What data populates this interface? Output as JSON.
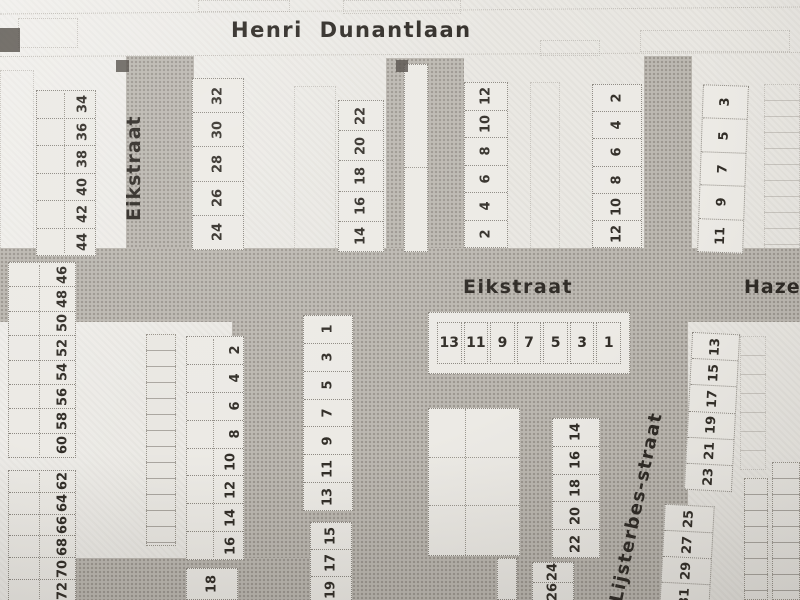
{
  "streets": {
    "henri_dunantlaan": "Henri Dunantlaan",
    "eikstraat_north": "Eikstraat",
    "eikstraat_mid": "Eikstraat",
    "hazelaarstraat_partial": "Hazela",
    "lijsterbesstraat": "Lijsterbes-straat"
  },
  "blocks": {
    "b34_44": [
      "34",
      "36",
      "38",
      "40",
      "42",
      "44"
    ],
    "b46_60": [
      "46",
      "48",
      "50",
      "52",
      "54",
      "56",
      "58",
      "60"
    ],
    "b62_72": [
      "62",
      "64",
      "66",
      "68",
      "70",
      "72"
    ],
    "b24_32": [
      "32",
      "30",
      "28",
      "26",
      "24"
    ],
    "b14_22_top": [
      "22",
      "20",
      "18",
      "16",
      "14"
    ],
    "b2_12_west": [
      "12",
      "10",
      "8",
      "6",
      "4",
      "2"
    ],
    "b2_12_east": [
      "2",
      "4",
      "6",
      "8",
      "10",
      "12"
    ],
    "b3_11": [
      "3",
      "5",
      "7",
      "9",
      "11"
    ],
    "row_1_13": [
      "13",
      "11",
      "9",
      "7",
      "5",
      "3",
      "1"
    ],
    "b2_16": [
      "2",
      "4",
      "6",
      "8",
      "10",
      "12",
      "14",
      "16"
    ],
    "b18": [
      "18"
    ],
    "col_1_13": [
      "1",
      "3",
      "5",
      "7",
      "9",
      "11",
      "13"
    ],
    "b15_19": [
      "15",
      "17",
      "19"
    ],
    "b14_22_mid": [
      "14",
      "16",
      "18",
      "20",
      "22"
    ],
    "b24_26": [
      "24",
      "26"
    ],
    "b13_23": [
      "13",
      "15",
      "17",
      "19",
      "21",
      "23"
    ],
    "b25_31": [
      "25",
      "27",
      "29",
      "31"
    ]
  },
  "map_markers": [
    "solid-square-marker",
    "solid-square-marker",
    "solid-square-marker"
  ],
  "colors": {
    "paper": "#e9e7e2",
    "street_fill": "#bcb8b1",
    "block_fill": "#eceae5",
    "outline": "#8e8a83",
    "ink": "#2f2b26"
  }
}
